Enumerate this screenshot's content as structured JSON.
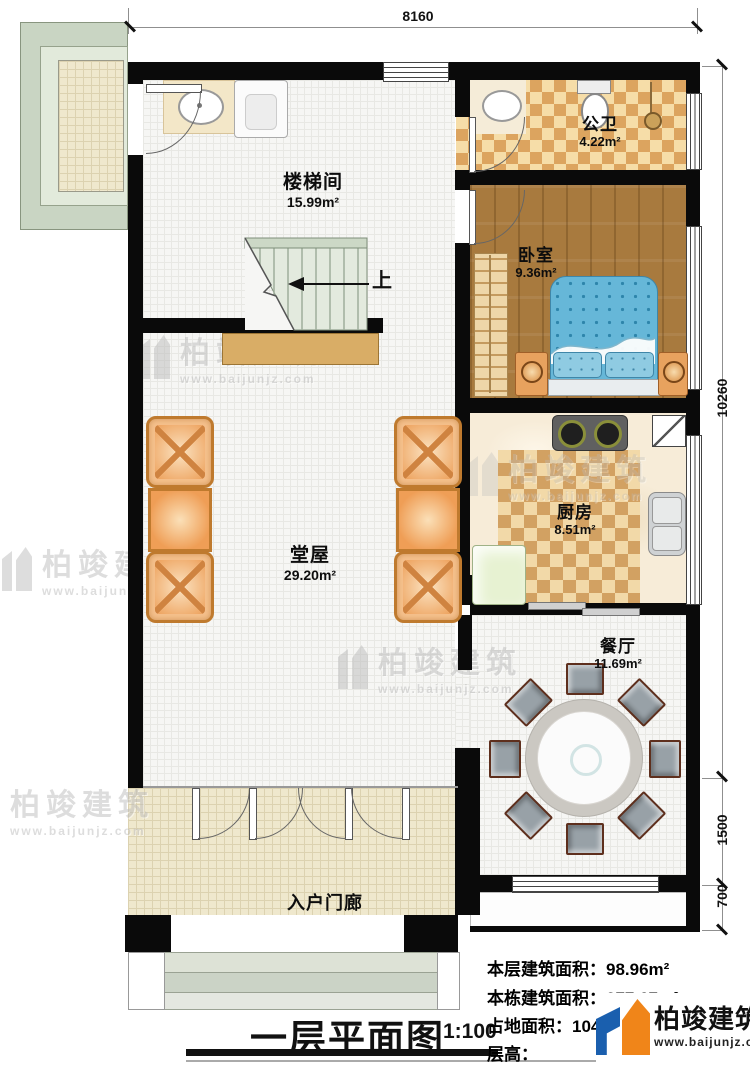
{
  "annotations": {
    "dim_top": "8160",
    "dim_right_main": "10260",
    "dim_right_mid": "1500",
    "dim_right_bottom": "700"
  },
  "rooms": {
    "stairwell": {
      "name": "楼梯间",
      "area": "15.99m²"
    },
    "bathroom": {
      "name": "公卫",
      "area": "4.22m²"
    },
    "bedroom": {
      "name": "卧室",
      "area": "9.36m²"
    },
    "kitchen": {
      "name": "厨房",
      "area": "8.51m²"
    },
    "hall": {
      "name": "堂屋",
      "area": "29.20m²"
    },
    "dining": {
      "name": "餐厅",
      "area": "11.69m²"
    },
    "porch": {
      "name": "入户门廊"
    }
  },
  "stair": {
    "up": "上"
  },
  "title_block": {
    "title": "一层平面图",
    "scale": "1:100"
  },
  "stats": {
    "floor_area": {
      "label": "本层建筑面积：",
      "value": "98.96m²"
    },
    "total_area": {
      "label": "本栋建筑面积：",
      "value": "277.67m²"
    },
    "footprint": {
      "label": "占地面积：",
      "value": "104."
    },
    "storey_height": {
      "label": "层高：",
      "value": ""
    }
  },
  "brand": {
    "name": "柏竣建筑",
    "url": "www.baijunjz.com"
  },
  "watermark": {
    "name": "柏竣建筑",
    "url": "www.baijunjz.com"
  },
  "colors": {
    "wall": "#0a0a0a",
    "brand_blue": "#1a5fae",
    "brand_orange": "#f08519"
  }
}
